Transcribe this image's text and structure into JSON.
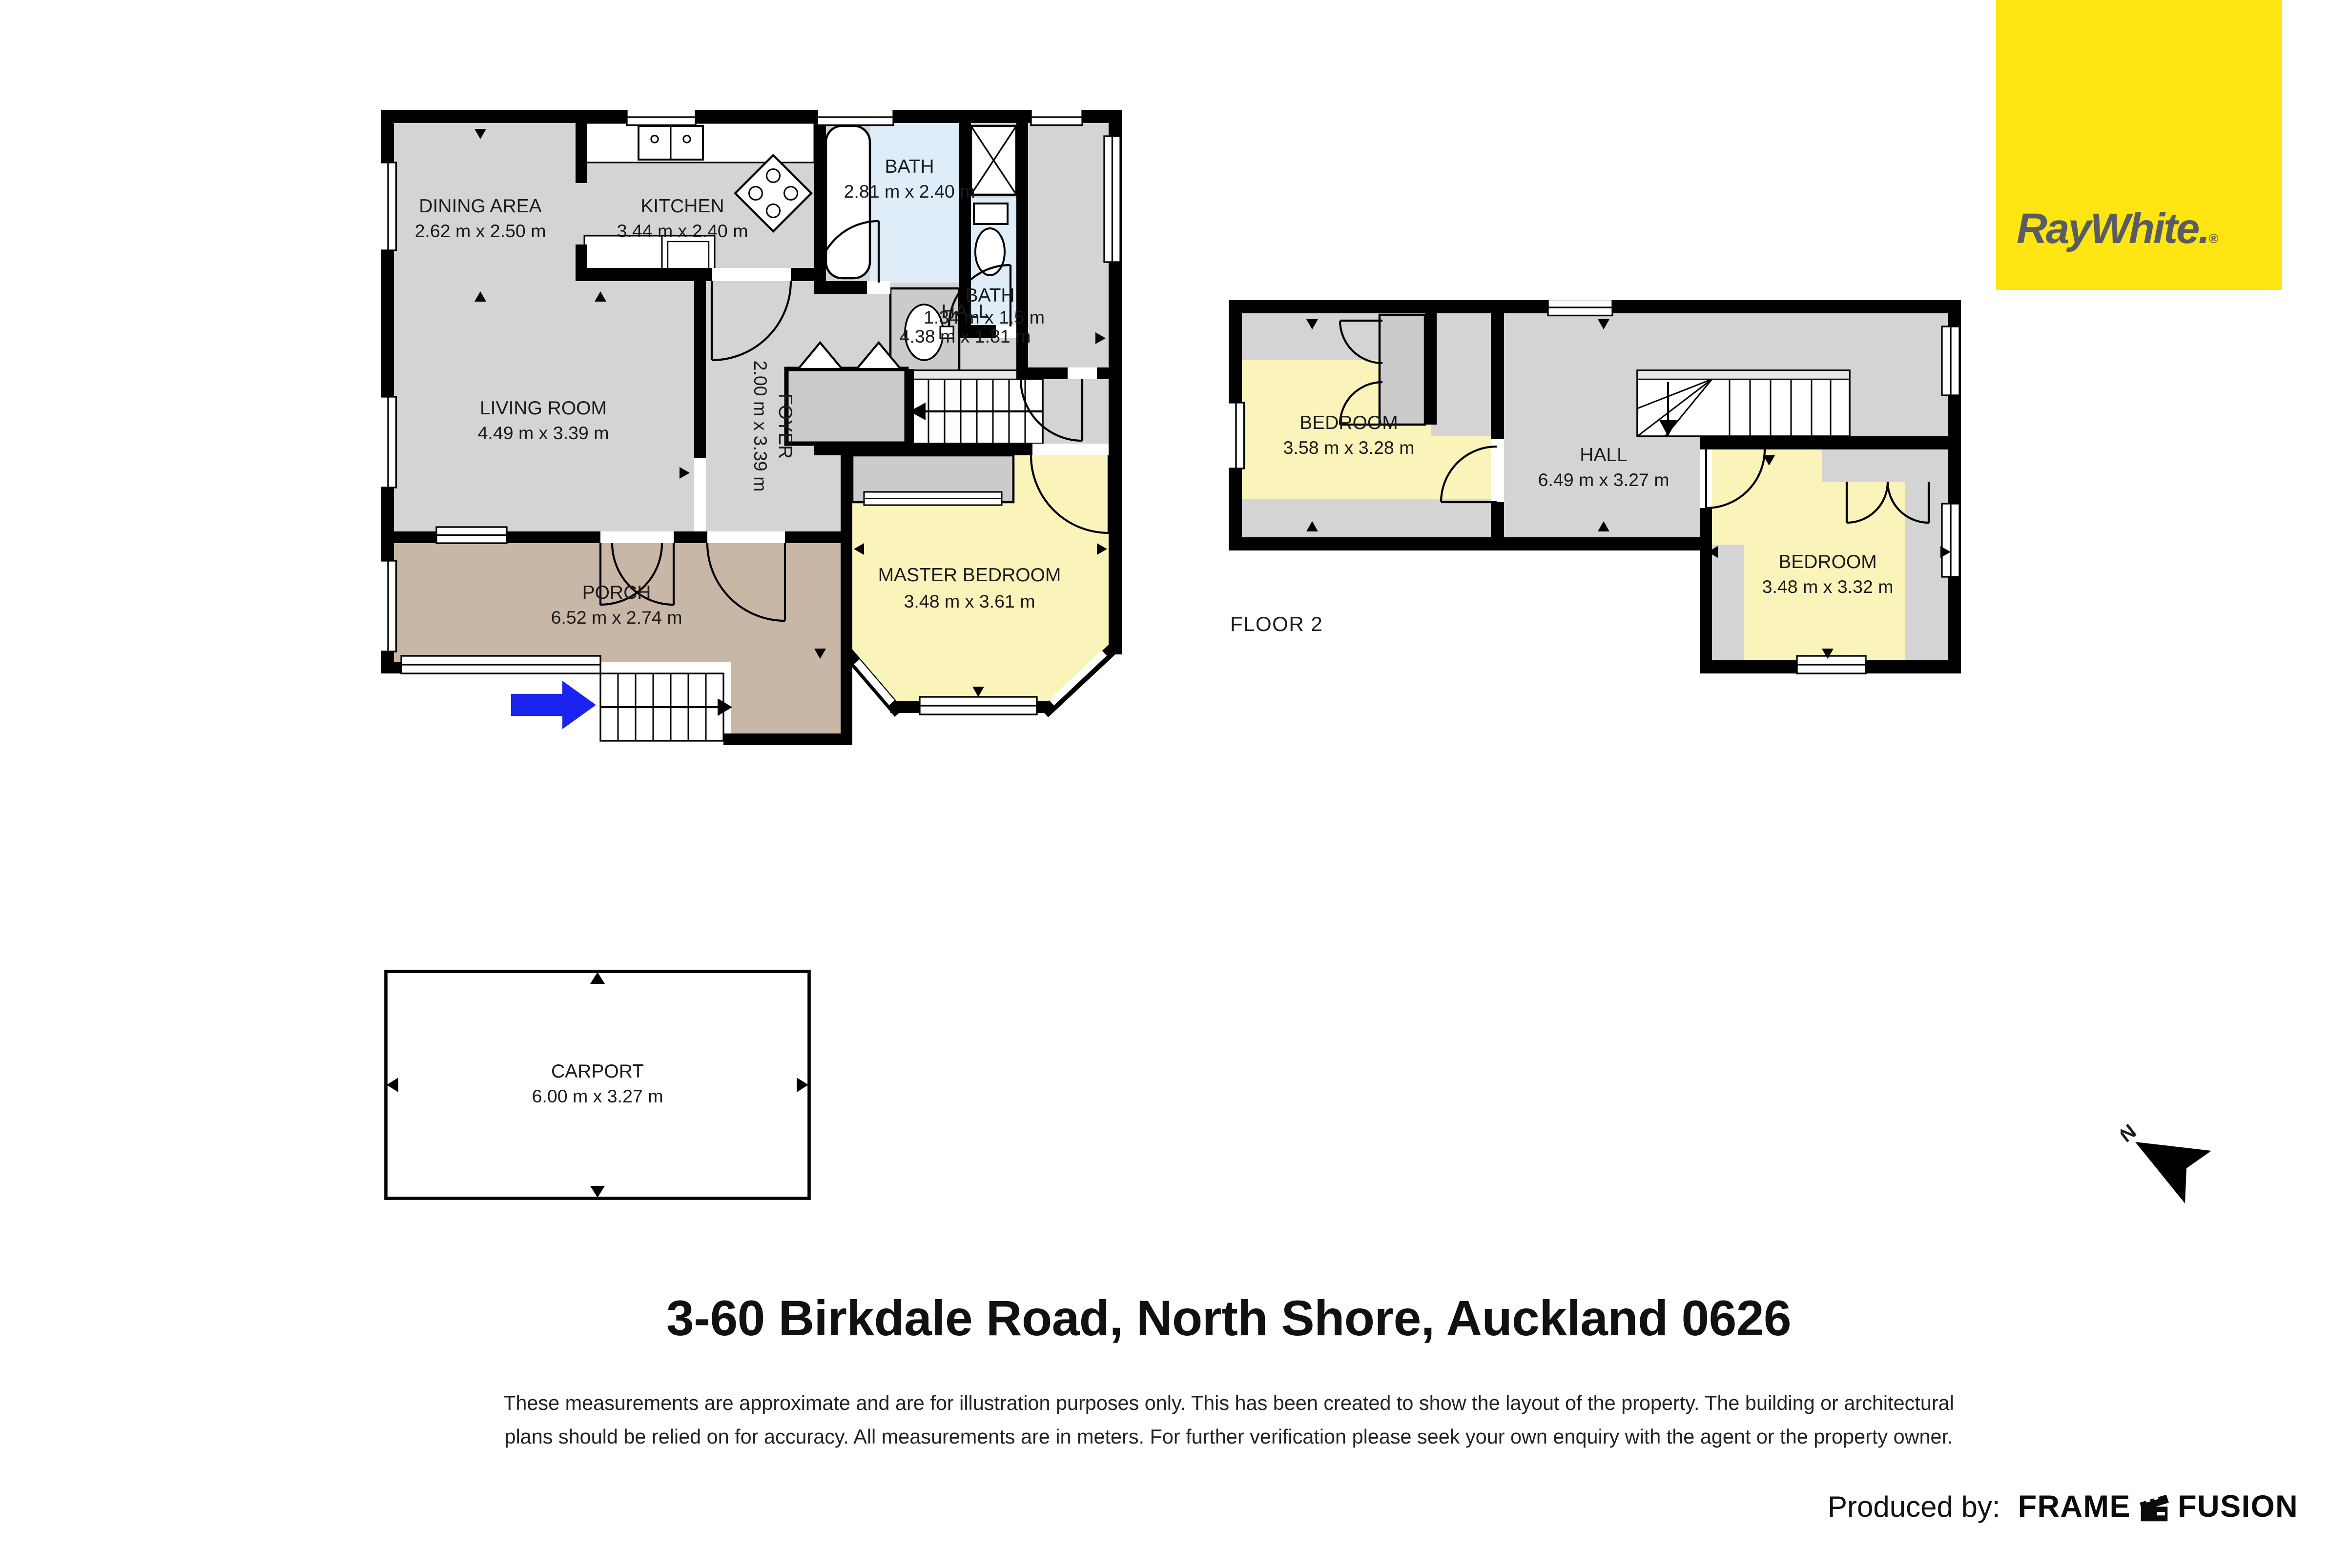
{
  "brand": {
    "logo_text": "RayWhite.",
    "registered_mark": "®"
  },
  "floor1": {
    "rooms": {
      "dining": {
        "name": "DINING AREA",
        "dims": "2.62 m x 2.50 m"
      },
      "kitchen": {
        "name": "KITCHEN",
        "dims": "3.44 m x 2.40 m"
      },
      "bath_main": {
        "name": "BATH",
        "dims": "2.81 m x 2.40 m"
      },
      "bath_small": {
        "name": "BATH",
        "dims": "1.34 m x 1.5 m"
      },
      "hall": {
        "name": "HALL",
        "dims": "4.38 m x 1.81 m"
      },
      "living": {
        "name": "LIVING ROOM",
        "dims": "4.49 m x 3.39 m"
      },
      "foyer": {
        "name": "FOYER",
        "dims": "2.00 m x 3.39 m"
      },
      "master": {
        "name": "MASTER BEDROOM",
        "dims": "3.48 m x 3.61 m"
      },
      "porch": {
        "name": "PORCH",
        "dims": "6.52 m x 2.74 m"
      }
    }
  },
  "floor2": {
    "label": "FLOOR 2",
    "rooms": {
      "bedroom_left": {
        "name": "BEDROOM",
        "dims": "3.58 m x 3.28 m"
      },
      "hall": {
        "name": "HALL",
        "dims": "6.49 m x 3.27 m"
      },
      "bedroom_right": {
        "name": "BEDROOM",
        "dims": "3.48 m x 3.32 m"
      }
    }
  },
  "carport": {
    "name": "CARPORT",
    "dims": "6.00 m x 3.27 m"
  },
  "compass": {
    "north_label": "N"
  },
  "footer": {
    "address": "3-60 Birkdale Road, North Shore, Auckland 0626",
    "disclaimer_line1": "These measurements are approximate and are for illustration purposes only. This has been created to show the layout of the property. The building or architectural",
    "disclaimer_line2": "plans should be relied on for accuracy. All measurements are in meters. For further verification please seek your own enquiry with the agent or the property owner.",
    "produced_by_label": "Produced by:",
    "producer_word1": "FRAME",
    "producer_word2": "FUSION"
  },
  "colors": {
    "wall": "#000000",
    "room_gray": "#d4d4d4",
    "closet_gray": "#cbcbcb",
    "bedroom_yellow": "#FAF3BA",
    "bath_blue": "#DFEDF9",
    "porch_tan": "#C8B7A7",
    "carport_white": "#ffffff",
    "brand_yellow": "#FFE512",
    "brand_text_gray": "#595D63",
    "entry_arrow_blue": "#1B23EE"
  }
}
